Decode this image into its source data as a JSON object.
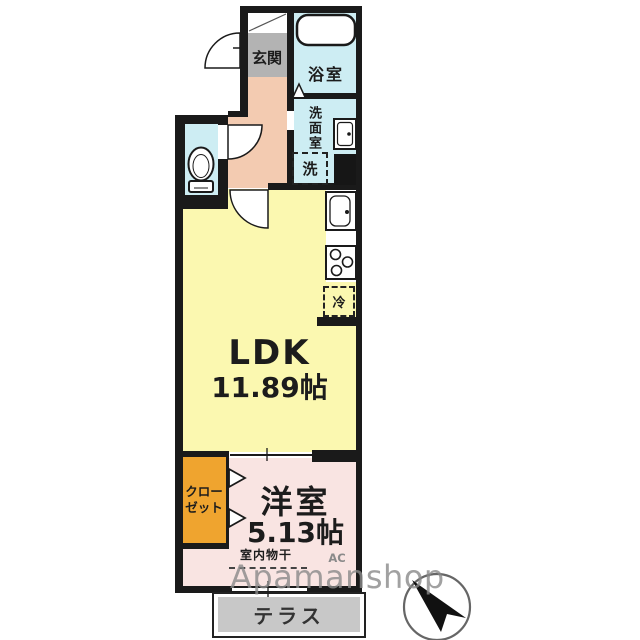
{
  "plan_title": "1LDK floor plan",
  "labels": {
    "genkan": "玄関",
    "bathroom": "浴室",
    "washroom": "洗面室",
    "washer": "洗",
    "ldk_name": "LDK",
    "ldk_size": "11.89帖",
    "fridge": "冷",
    "closet_line1": "クロー",
    "closet_line2": "ゼット",
    "bedroom_name": "洋室",
    "bedroom_size": "5.13帖",
    "indoor_drying": "室内物干",
    "ac": "AC",
    "terrace": "テラス"
  },
  "watermark": "Apamanshop",
  "colors": {
    "wall": "#1a1a1a",
    "tile": "#b3b3b3",
    "hall": "#f3cbb1",
    "wet": "#cdedf3",
    "ldk": "#fbf8b0",
    "bed": "#f9e4e2",
    "closet": "#efa42f",
    "terrace": "#c8c8c8",
    "label": "#1c1c1c",
    "watermark_color": "#8a8a8a"
  }
}
